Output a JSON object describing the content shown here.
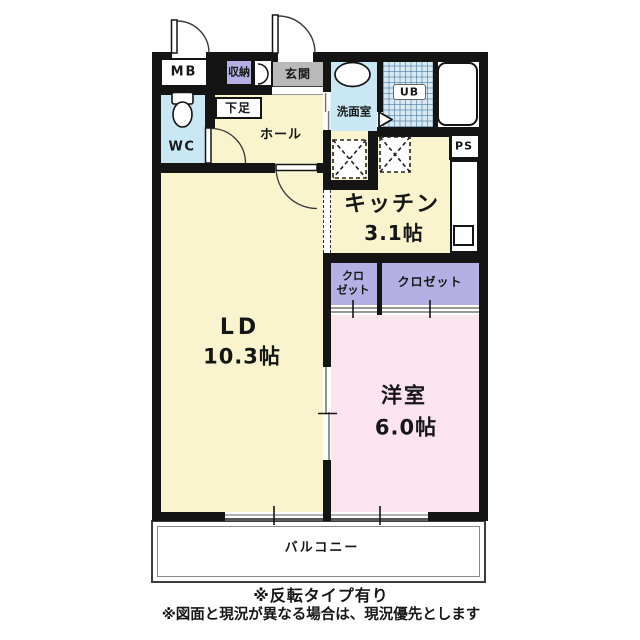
{
  "floorplan": {
    "labels": {
      "meter_box": "MB",
      "storage": "収納",
      "entrance": "玄関",
      "shoe_box": "下足",
      "wc": "WC",
      "hall": "ホール",
      "washroom": "洗面室",
      "unit_bath": "UB",
      "pipe_space": "PS",
      "kitchen_name": "キッチン",
      "kitchen_size": "3.1帖",
      "closet_small_line1": "クロ",
      "closet_small_line2": "ゼット",
      "closet_large": "クロゼット",
      "living_name": "LD",
      "living_size": "10.3帖",
      "bedroom_name": "洋室",
      "bedroom_size": "6.0帖",
      "balcony": "バルコニー"
    },
    "notes": {
      "line1": "※反転タイプ有り",
      "line2": "※図面と現況が異なる場合は、現況優先とします"
    },
    "colors": {
      "room_cream": "#f9f4cd",
      "room_pink": "#fce4ee",
      "closet_lavender": "#b6afe3",
      "water_blue": "#cae7f4",
      "entrance_gray": "#b9b9b9",
      "wall_black": "#141414"
    }
  }
}
